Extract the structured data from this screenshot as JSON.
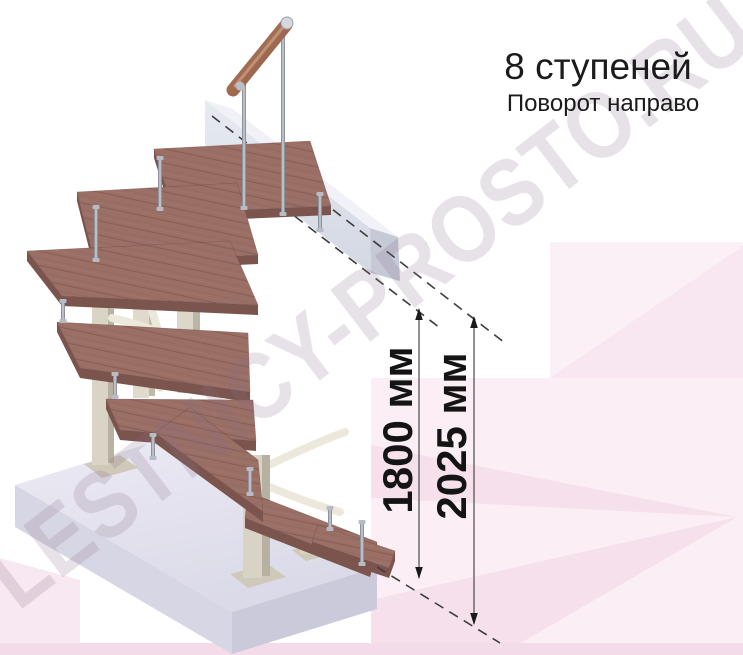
{
  "title": {
    "steps": "8 ступеней",
    "turn": "Поворот направо"
  },
  "dimensions": {
    "d1800": "1800 мм",
    "d2025": "2025 мм"
  },
  "watermark": {
    "text": "LESTNICY-PROSTO.RU"
  },
  "colors": {
    "background": "#ffffff",
    "pink_panel_light": "#fcf0f7",
    "pink_panel_mid": "#f8e6f0",
    "pink_strip_bottom": "#f4dbe9",
    "wood_tread": "#9a6f66",
    "wood_tread_edge": "#7b544e",
    "handrail_wood": "#a06b55",
    "support_post": "#d9d4c5",
    "support_post_shade": "#b8b2a2",
    "beam_face": "#dfe3ec",
    "beam_end": "#c6cad7",
    "floor_slab": "#e4e3ee",
    "metal_baluster": "#8f939c",
    "dimension_text": "#141414",
    "title_text": "#1b1b1b",
    "dash_line": "#3d3d3d"
  }
}
